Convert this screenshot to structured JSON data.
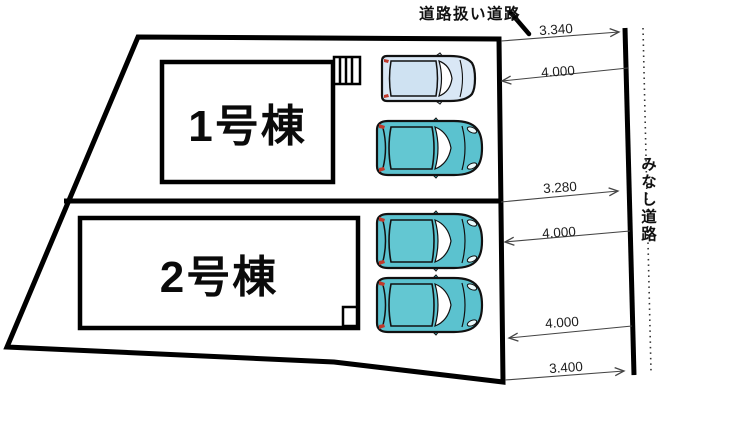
{
  "diagram": {
    "type": "residential-site-plan",
    "buildings": [
      {
        "label": "1号棟"
      },
      {
        "label": "2号棟"
      }
    ],
    "roads": {
      "top_label": "道路扱い道路",
      "right_label": "みなし道路"
    },
    "dimensions": [
      {
        "label": "3.340",
        "arrow": "right"
      },
      {
        "label": "4.000",
        "arrow": "left"
      },
      {
        "label": "3.280",
        "arrow": "right"
      },
      {
        "label": "4.000",
        "arrow": "left"
      },
      {
        "label": "4.000",
        "arrow": "left"
      },
      {
        "label": "3.400",
        "arrow": "right"
      }
    ],
    "cars": [
      {
        "type": "van",
        "color": "#d9e7f5"
      },
      {
        "type": "hatchback",
        "color": "#5bc2cf"
      },
      {
        "type": "hatchback",
        "color": "#5bc2cf"
      },
      {
        "type": "hatchback",
        "color": "#5bc2cf"
      }
    ],
    "colors": {
      "outline": "#000000",
      "dimension_line": "#444444",
      "car_teal": "#5bc2cf",
      "car_light_blue": "#d9e7f5"
    }
  }
}
